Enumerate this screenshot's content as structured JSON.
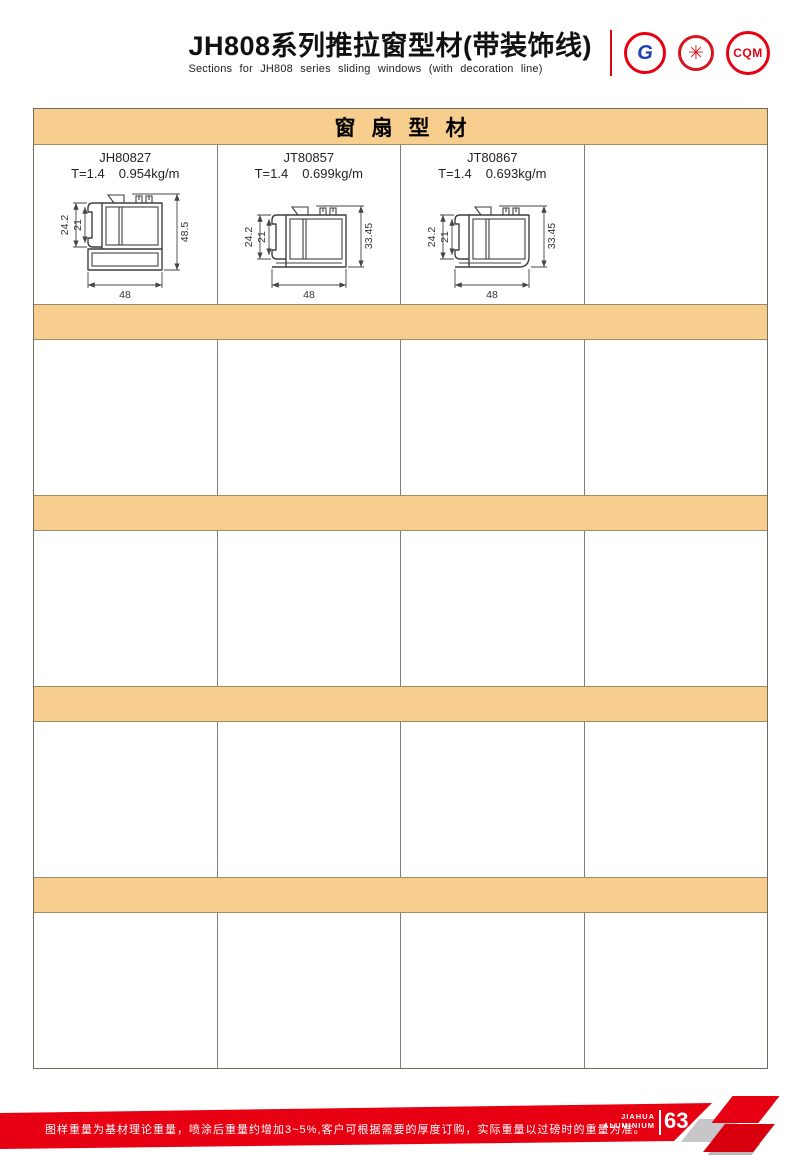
{
  "header": {
    "title_cn": "JH808系列推拉窗型材(带装饰线)",
    "title_en": "Sections for JH808 series sliding windows (with decoration line)",
    "logos": [
      {
        "name": "gb-certification-logo",
        "glyph": "G"
      },
      {
        "name": "quality-seal-logo",
        "glyph": "✳"
      },
      {
        "name": "cqm-certification-logo",
        "glyph": "CQM"
      }
    ]
  },
  "section": {
    "title": "窗扇型材"
  },
  "products": [
    {
      "model": "JH80827",
      "thickness": "T=1.4",
      "weight": "0.954kg/m",
      "dim_outer": "24.2",
      "dim_inner": "21",
      "dim_height": "48.5",
      "dim_width": "48"
    },
    {
      "model": "JT80857",
      "thickness": "T=1.4",
      "weight": "0.699kg/m",
      "dim_outer": "24.2",
      "dim_inner": "21",
      "dim_height": "33.45",
      "dim_width": "48"
    },
    {
      "model": "JT80867",
      "thickness": "T=1.4",
      "weight": "0.693kg/m",
      "dim_outer": "24.2",
      "dim_inner": "21",
      "dim_height": "33.45",
      "dim_width": "48"
    }
  ],
  "footer": {
    "note": "图样重量为基材理论重量，喷涂后重量约增加3~5%,客户可根据需要的厚度订购，实际重量以过磅时的重量为准。",
    "brand_top": "JIAHUA",
    "brand_bottom": "ALUMINIUM",
    "page_number": "63"
  },
  "colors": {
    "accent_red": "#e60012",
    "band_orange": "#f8ce8e",
    "grid_gray": "#7d7d7d"
  }
}
